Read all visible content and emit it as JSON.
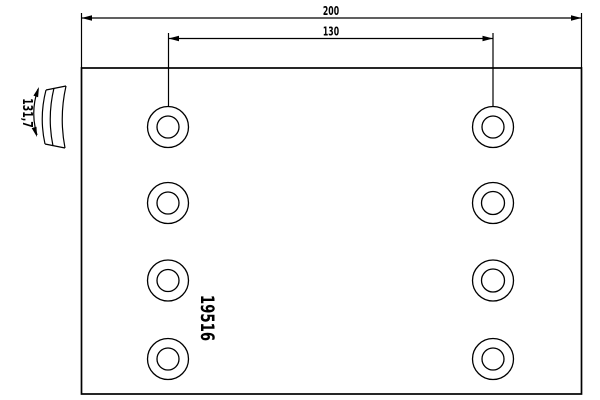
{
  "drawing": {
    "type": "brake-lining-technical-drawing",
    "part_number": "19516",
    "dimensions": {
      "overall_width": "200",
      "hole_spacing": "130",
      "arc_width": "131,7"
    },
    "holes": {
      "rows": 4,
      "columns": 2,
      "count": 8
    },
    "colors": {
      "line": "#000000",
      "background": "#ffffff"
    }
  }
}
